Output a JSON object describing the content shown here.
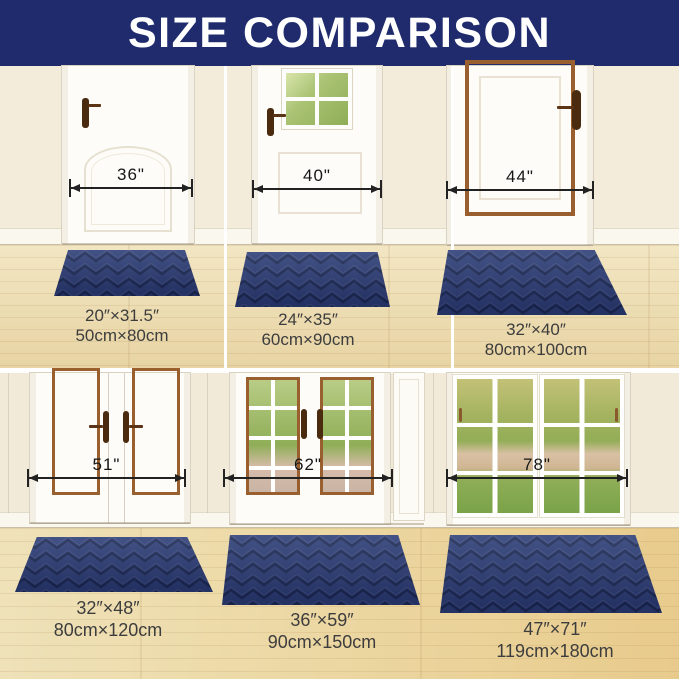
{
  "title": "SIZE COMPARISON",
  "colors": {
    "banner_navy": "#1f2b6d",
    "mat_navy": "#2e3f78",
    "mat_groove": "#1e2b55",
    "wall_cream": "#f3ecdb",
    "floor_wood": "#ecd9a6",
    "door_trim_copper": "#9a5f2e",
    "handle_brown": "#4a2b10"
  },
  "panels": [
    {
      "door_width": "36\"",
      "mat_size_in": "20″×31.5″",
      "mat_size_cm": "50cm×80cm"
    },
    {
      "door_width": "40\"",
      "mat_size_in": "24″×35″",
      "mat_size_cm": "60cm×90cm"
    },
    {
      "door_width": "44\"",
      "mat_size_in": "32″×40″",
      "mat_size_cm": "80cm×100cm"
    },
    {
      "door_width": "51\"",
      "mat_size_in": "32″×48″",
      "mat_size_cm": "80cm×120cm"
    },
    {
      "door_width": "62\"",
      "mat_size_in": "36″×59″",
      "mat_size_cm": "90cm×150cm"
    },
    {
      "door_width": "78\"",
      "mat_size_in": "47″×71″",
      "mat_size_cm": "119cm×180cm"
    }
  ]
}
